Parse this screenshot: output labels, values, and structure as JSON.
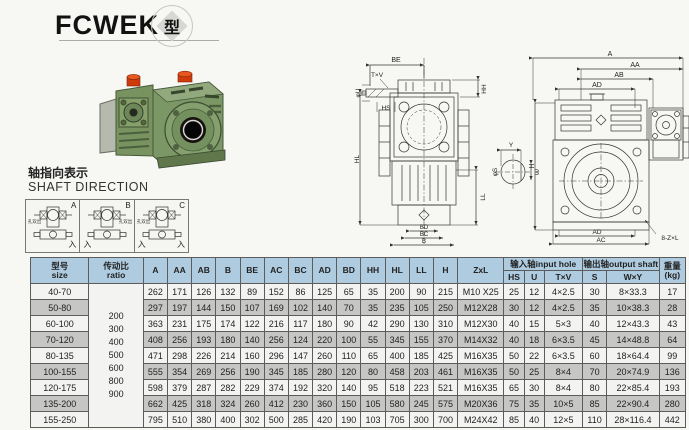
{
  "page": {
    "title": "FCWEK",
    "title_badge": "型"
  },
  "colors": {
    "table_header_bg": "#aecbdf",
    "row_shade": "#c6c6c4",
    "gearbox_green": "#7b9765",
    "cap_red": "#d0390f"
  },
  "shaft_direction": {
    "label_cn": "轴指向表示",
    "label_en": "SHAFT DIRECTION",
    "cells": [
      {
        "letter": "A",
        "side_label": "孔双出",
        "in_left": "",
        "in_right": "入"
      },
      {
        "letter": "B",
        "side_label": "孔双出",
        "in_left": "入",
        "in_right": ""
      },
      {
        "letter": "C",
        "side_label": "孔双出",
        "in_left": "入",
        "in_right": "入"
      }
    ]
  },
  "drawings": {
    "front_view": {
      "be": "BE",
      "txv": "T×V",
      "u": "φU",
      "hs": "HS",
      "hh": "HH",
      "hl": "HL",
      "ll": "LL",
      "bd": "BD",
      "bc": "BC",
      "b": "B"
    },
    "shaft_detail": {
      "y": "Y",
      "s": "φS",
      "w": "W"
    },
    "side_view": {
      "a": "A",
      "aa": "AA",
      "ab": "AB",
      "ad_top": "AD",
      "h": "H",
      "ad_bottom": "AD",
      "ac": "AC",
      "note": "8-Z×L"
    }
  },
  "table": {
    "headers": {
      "size_cn": "型号",
      "size_en": "size",
      "ratio_cn": "传动比",
      "ratio_en": "ratio",
      "dims": [
        "A",
        "AA",
        "AB",
        "B",
        "BE",
        "AC",
        "BC",
        "AD",
        "BD",
        "HH",
        "HL",
        "LL",
        "H"
      ],
      "zxl": "ZxL",
      "input_group": "输入轴input hole",
      "input_cols": [
        "HS",
        "U",
        "T×V"
      ],
      "output_group": "输出轴output shaft",
      "output_cols": [
        "S",
        "W×Y"
      ],
      "weight_cn": "重量",
      "weight_en": "(kg)"
    },
    "ratio_values": [
      "200",
      "300",
      "400",
      "500",
      "600",
      "800",
      "900"
    ],
    "rows": [
      {
        "size": "40-70",
        "dims": [
          "262",
          "171",
          "126",
          "132",
          "89",
          "152",
          "86",
          "125",
          "65",
          "35",
          "200",
          "90",
          "215"
        ],
        "zxl": "M10 X25",
        "input": [
          "25",
          "12",
          "4×2.5"
        ],
        "output": [
          "30",
          "8×33.3"
        ],
        "kg": "17"
      },
      {
        "size": "50-80",
        "dims": [
          "297",
          "197",
          "144",
          "150",
          "107",
          "169",
          "102",
          "140",
          "70",
          "35",
          "235",
          "105",
          "250"
        ],
        "zxl": "M12X28",
        "input": [
          "30",
          "12",
          "4×2.5"
        ],
        "output": [
          "35",
          "10×38.3"
        ],
        "kg": "28"
      },
      {
        "size": "60-100",
        "dims": [
          "363",
          "231",
          "175",
          "174",
          "122",
          "216",
          "117",
          "180",
          "90",
          "42",
          "290",
          "130",
          "310"
        ],
        "zxl": "M12X30",
        "input": [
          "40",
          "15",
          "5×3"
        ],
        "output": [
          "40",
          "12×43.3"
        ],
        "kg": "43"
      },
      {
        "size": "70-120",
        "dims": [
          "408",
          "256",
          "193",
          "180",
          "140",
          "256",
          "124",
          "220",
          "100",
          "55",
          "345",
          "155",
          "370"
        ],
        "zxl": "M14X32",
        "input": [
          "40",
          "18",
          "6×3.5"
        ],
        "output": [
          "45",
          "14×48.8"
        ],
        "kg": "64"
      },
      {
        "size": "80-135",
        "dims": [
          "471",
          "298",
          "226",
          "214",
          "160",
          "296",
          "147",
          "260",
          "110",
          "65",
          "400",
          "185",
          "425"
        ],
        "zxl": "M16X35",
        "input": [
          "50",
          "22",
          "6×3.5"
        ],
        "output": [
          "60",
          "18×64.4"
        ],
        "kg": "99"
      },
      {
        "size": "100-155",
        "dims": [
          "555",
          "354",
          "269",
          "256",
          "190",
          "345",
          "185",
          "280",
          "120",
          "80",
          "458",
          "203",
          "461"
        ],
        "zxl": "M16X35",
        "input": [
          "50",
          "25",
          "8×4"
        ],
        "output": [
          "70",
          "20×74.9"
        ],
        "kg": "136"
      },
      {
        "size": "120-175",
        "dims": [
          "598",
          "379",
          "287",
          "282",
          "229",
          "374",
          "192",
          "320",
          "140",
          "95",
          "518",
          "223",
          "521"
        ],
        "zxl": "M16X35",
        "input": [
          "65",
          "30",
          "8×4"
        ],
        "output": [
          "80",
          "22×85.4"
        ],
        "kg": "193"
      },
      {
        "size": "135-200",
        "dims": [
          "662",
          "425",
          "318",
          "324",
          "260",
          "412",
          "230",
          "360",
          "150",
          "105",
          "580",
          "245",
          "575"
        ],
        "zxl": "M20X36",
        "input": [
          "75",
          "35",
          "10×5"
        ],
        "output": [
          "85",
          "22×90.4"
        ],
        "kg": "280"
      },
      {
        "size": "155-250",
        "dims": [
          "795",
          "510",
          "380",
          "400",
          "302",
          "500",
          "285",
          "420",
          "190",
          "103",
          "705",
          "300",
          "700"
        ],
        "zxl": "M24X42",
        "input": [
          "85",
          "40",
          "12×5"
        ],
        "output": [
          "110",
          "28×116.4"
        ],
        "kg": "442"
      }
    ]
  }
}
